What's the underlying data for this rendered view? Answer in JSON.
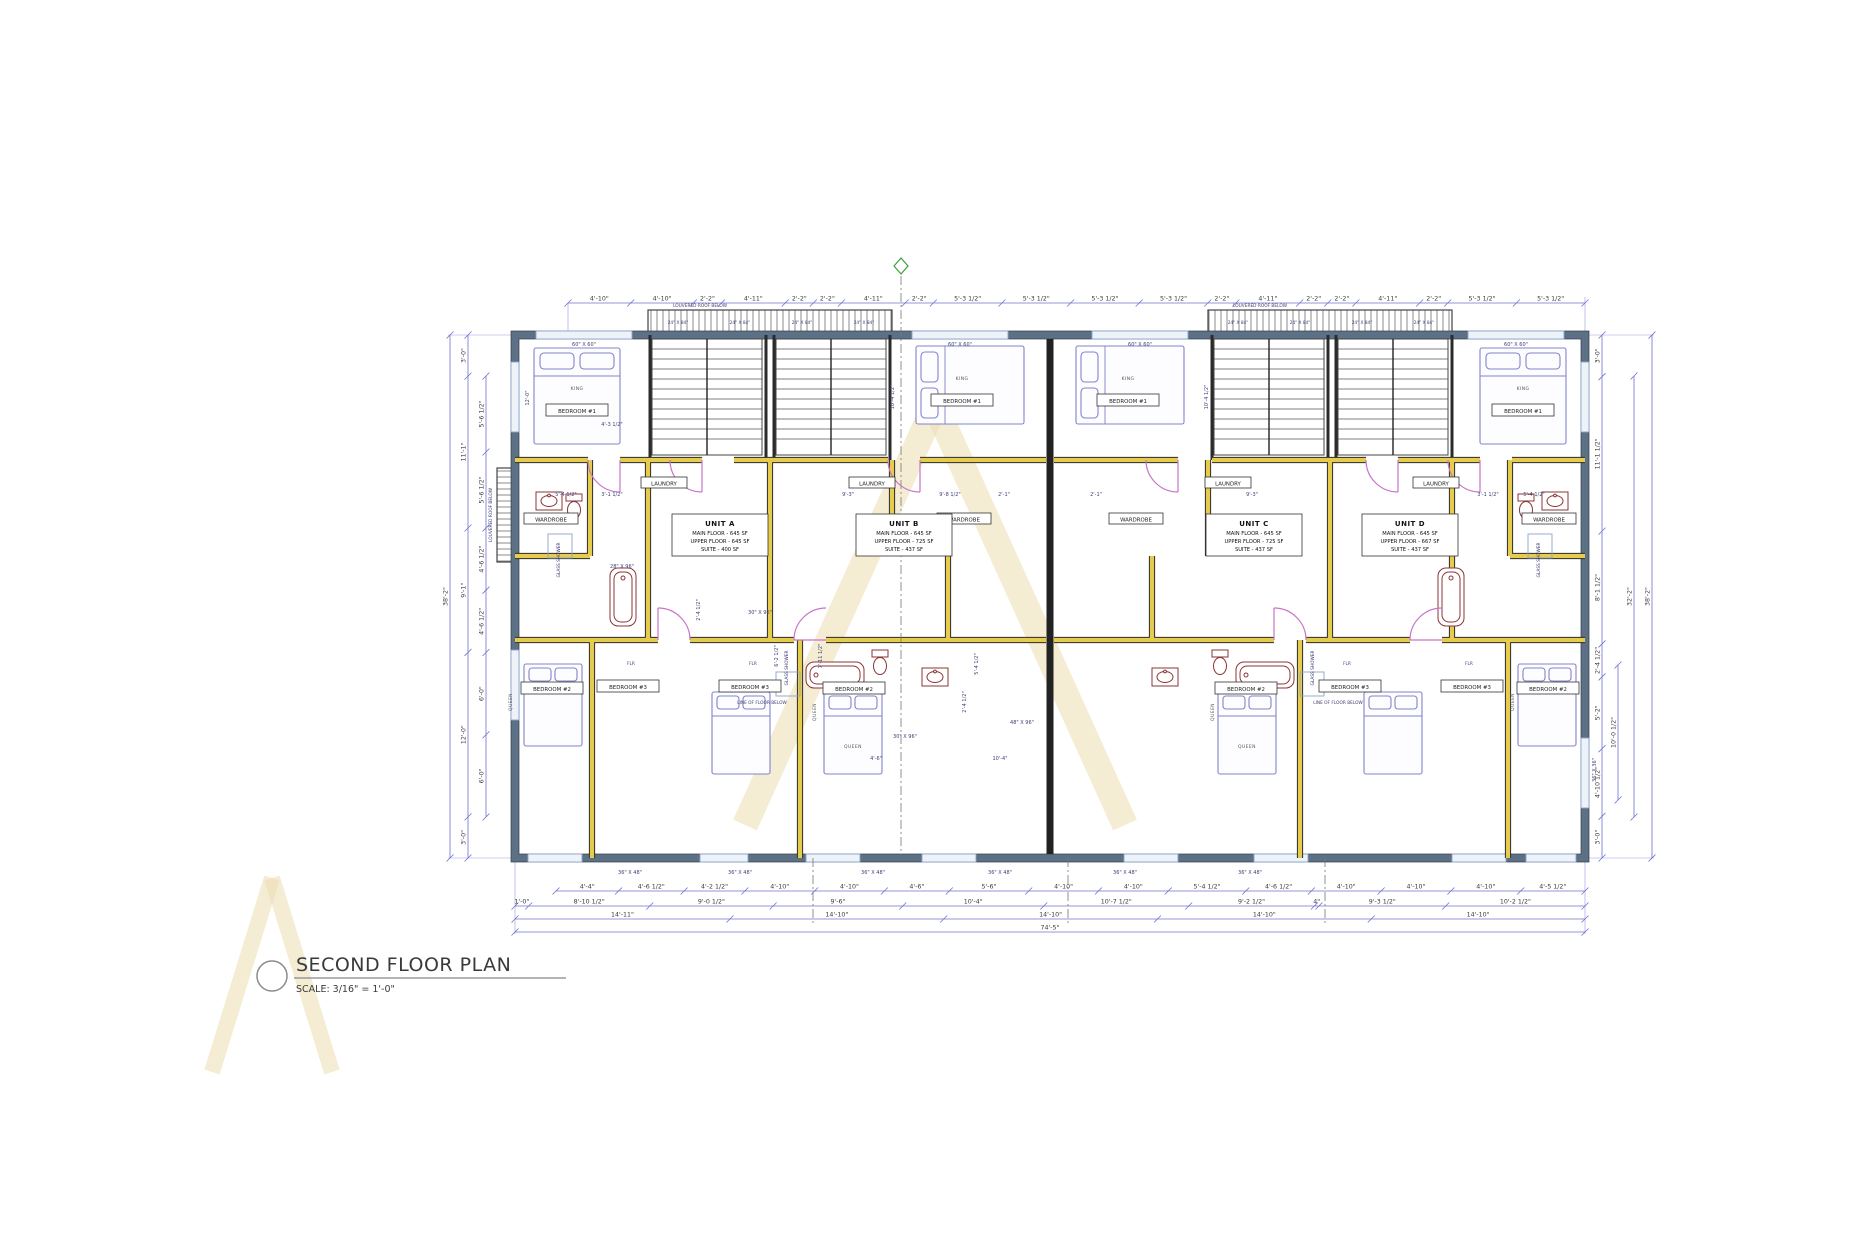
{
  "title_block": {
    "title": "SECOND FLOOR PLAN",
    "scale": "SCALE: 3/16\" = 1'-0\""
  },
  "units": [
    {
      "name": "UNIT A",
      "line1": "MAIN FLOOR - 645 SF",
      "line2": "UPPER FLOOR - 645 SF",
      "line3": "SUITE - 400 SF"
    },
    {
      "name": "UNIT B",
      "line1": "MAIN FLOOR - 645 SF",
      "line2": "UPPER FLOOR - 725 SF",
      "line3": "SUITE - 437 SF"
    },
    {
      "name": "UNIT C",
      "line1": "MAIN FLOOR - 645 SF",
      "line2": "UPPER FLOOR - 725 SF",
      "line3": "SUITE - 437 SF"
    },
    {
      "name": "UNIT D",
      "line1": "MAIN FLOOR - 645 SF",
      "line2": "UPPER FLOOR - 667 SF",
      "line3": "SUITE - 437 SF"
    }
  ],
  "rooms": {
    "bedroom1": "BEDROOM #1",
    "bedroom2": "BEDROOM #2",
    "bedroom3": "BEDROOM #3",
    "wardrobe": "WARDROBE",
    "laundry": "LAUNDRY",
    "glass_shower": "GLASS SHOWER",
    "king": "KING",
    "queen": "QUEEN",
    "flr": "FLR"
  },
  "annotations": {
    "louvered_roof": "LOUVERED ROOF BELOW",
    "line_of_floor": "LINE OF FLOOR BELOW"
  },
  "sizes": {
    "louver": "24\" X 84\"",
    "top_window": "60\" X 60\"",
    "bottom_window": "36\" X 48\"",
    "side_window": "36\" X 36\""
  },
  "dims": {
    "top": [
      "4'-10\"",
      "4'-10\"",
      "2'-2\"",
      "4'-11\"",
      "2'-2\"",
      "2'-2\"",
      "4'-11\"",
      "2'-2\"",
      "5'-3 1/2\"",
      "5'-3 1/2\"",
      "5'-3 1/2\"",
      "5'-3 1/2\"",
      "2'-2\"",
      "4'-11\"",
      "2'-2\"",
      "2'-2\"",
      "4'-11\"",
      "2'-2\"",
      "5'-3 1/2\"",
      "5'-3 1/2\""
    ],
    "bottom_r1": [
      "4'-4\"",
      "4'-6 1/2\"",
      "4'-2 1/2\"",
      "4'-10\"",
      "4'-10\"",
      "4'-6\"",
      "5'-6\"",
      "4'-10\"",
      "4'-10\"",
      "5'-4 1/2\"",
      "4'-6 1/2\"",
      "4'-10\"",
      "4'-10\"",
      "4'-10\"",
      "4'-5 1/2\""
    ],
    "bottom_r2": [
      "1'-0\"",
      "8'-10 1/2\"",
      "9'-0 1/2\"",
      "9'-6\"",
      "10'-4\"",
      "10'-7 1/2\"",
      "9'-2 1/2\"",
      "4\"",
      "9'-3 1/2\"",
      "10'-2 1/2\""
    ],
    "bottom_r3": [
      "14'-11\"",
      "14'-10\"",
      "14'-10\"",
      "14'-10\"",
      "14'-10\""
    ],
    "bottom_overall": "74'-5\"",
    "left_outer": "38'-2\"",
    "left_mid": [
      "3'-0\"",
      "11'-1\"",
      "9'-1\"",
      "12'-0\"",
      "3'-0\""
    ],
    "left_inner": [
      "5'-6 1/2\"",
      "5'-6 1/2\"",
      "4'-6 1/2\"",
      "4'-6 1/2\"",
      "6'-0\"",
      "6'-0\""
    ],
    "right_inner": [
      "3'-0\"",
      "11'-1 1/2\"",
      "8'-1 1/2\"",
      "2'-4 1/2\"",
      "5'-2\"",
      "4'-10 1/2\"",
      "3'-0\""
    ],
    "right_10": "10'-0 1/2\"",
    "right_mid": "32'-2\"",
    "right_outer": "38'-2\""
  },
  "interior_dims": [
    "4'-3 1/2\"",
    "10'-4 1/2\"",
    "10'-4 1/2\"",
    "5'-4 1/2\"",
    "3'-1 1/2\"",
    "9'-3\"",
    "9'-8 1/2\"",
    "2'-1\"",
    "6'-2 1/2\"",
    "7'-11 1/2\"",
    "2'-4 1/2\"",
    "2'-4 1/2\"",
    "5'-4 1/2\"",
    "10'-4\"",
    "4'-6\"",
    "30\" X 96\"",
    "30\" X 96\"",
    "48\" X 96\"",
    "28\" X 96\"",
    "2'-1\"",
    "9'-3\"",
    "3'-1 1/2\"",
    "5'-4 1/2\"",
    "12'-0\""
  ],
  "colors": {
    "dim_line": "#7070cf",
    "exterior_wall": "#5d7186",
    "interior_wall": "#e5cc4f",
    "party_wall": "#2b2b2b",
    "door": "#c873c8",
    "fixture": "#8a3434",
    "furniture": "#8084c8",
    "watermark": "#ecdcb0",
    "marker_green": "#3a9e3a"
  }
}
